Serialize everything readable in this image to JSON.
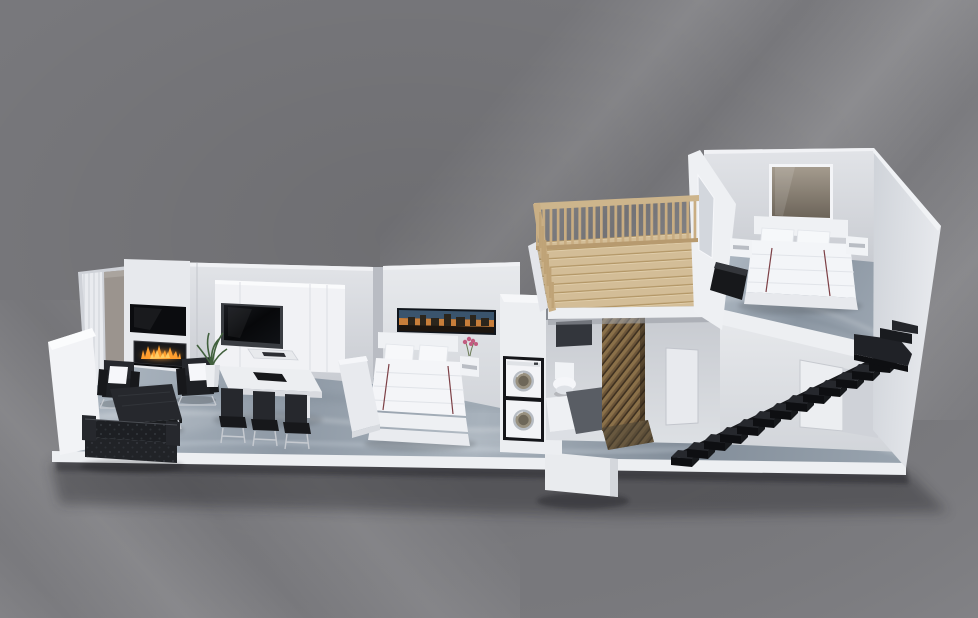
{
  "scene": {
    "title": "isometric-apartment-3d-floor-plan",
    "view": {
      "width": 978,
      "height": 618
    },
    "rooms": [
      "living-room",
      "dining-area",
      "bedroom",
      "laundry-closet",
      "bathroom",
      "hallway",
      "wood-loft",
      "master-bedroom",
      "staircase"
    ],
    "objects": [
      "tufted-sofa",
      "coffee-table",
      "armchair",
      "armchair",
      "fireplace",
      "fireplace-tv",
      "window-curtains",
      "potted-plant",
      "media-cabinet",
      "cabinet-tv",
      "dining-table",
      "dining-chairs",
      "bed-with-white-linen",
      "city-skyline-artwork",
      "nightstand-with-pink-flowers",
      "stacked-washer-dryer",
      "toilet",
      "bath-ledge",
      "mosaic-shower-screen",
      "wood-deck",
      "wood-railing",
      "master-bed",
      "wall-mirror",
      "floating-nightstands",
      "black-floating-stairs"
    ]
  },
  "palette": {
    "bg": "#7a7a7e",
    "bgDark": "#6e6e72",
    "bgStreak": "#9d9da3",
    "modelShadow": "#222226",
    "slab": "#edeff2",
    "wall": "#d9dbe0",
    "wallLight": "#e7e9ed",
    "wallBright": "#f2f3f6",
    "wallDim": "#c9ccd2",
    "floorLight": "#b3bdc7",
    "floorMid": "#929da9",
    "floorDark": "#7c8793",
    "wood": "#d3bd97",
    "woodDark": "#b39767",
    "rail": "#cdb58c",
    "black": "#17181b",
    "blackSoft": "#26282d",
    "charcoal": "#33363c",
    "chrome": "#c6cad0",
    "white": "#f6f7fa",
    "fire": "#ff9e2e",
    "fireInner": "#ffd169",
    "artSky": "#3a546d",
    "artGlow": "#c87e3a",
    "artDark": "#1c150f",
    "pink": "#c25b80",
    "plant": "#41603d",
    "mosaic": "#6d5639",
    "mosaicLight": "#8a7049",
    "tv": "#0b0c0f",
    "mirror": "#8a8174",
    "stripe": "#7d4046"
  }
}
